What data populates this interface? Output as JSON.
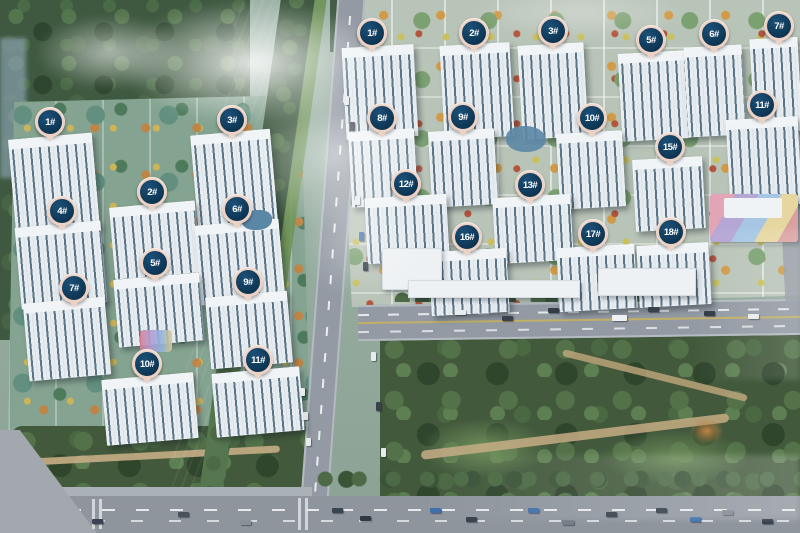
{
  "scene": {
    "type": "aerial-development-rendering",
    "description": "Bird's-eye 3D rendering of two residential communities separated by a river, with numbered building badge pins, roads with traffic, and parks"
  },
  "palette": {
    "marker_ring": "#ecd2c5",
    "marker_fill": "#0d3552",
    "marker_text": "#ffffff",
    "water": "#2b4251",
    "road": "#939aa3",
    "forest_green": "#3f5941",
    "park_green": "#42593b",
    "parcel_left_ground": "#85a391",
    "parcel_right_ground": "#b9c4b8"
  },
  "west_community": {
    "name": "west",
    "markers": [
      {
        "label": "1#",
        "x": 50,
        "y": 122
      },
      {
        "label": "2#",
        "x": 152,
        "y": 192
      },
      {
        "label": "3#",
        "x": 232,
        "y": 120
      },
      {
        "label": "4#",
        "x": 62,
        "y": 211
      },
      {
        "label": "5#",
        "x": 155,
        "y": 263
      },
      {
        "label": "6#",
        "x": 237,
        "y": 209
      },
      {
        "label": "7#",
        "x": 74,
        "y": 288
      },
      {
        "label": "9#",
        "x": 248,
        "y": 282
      },
      {
        "label": "10#",
        "x": 147,
        "y": 364
      },
      {
        "label": "11#",
        "x": 258,
        "y": 360
      }
    ]
  },
  "east_community": {
    "name": "east",
    "markers": [
      {
        "label": "1#",
        "x": 372,
        "y": 33
      },
      {
        "label": "2#",
        "x": 474,
        "y": 33
      },
      {
        "label": "3#",
        "x": 553,
        "y": 31
      },
      {
        "label": "5#",
        "x": 651,
        "y": 40
      },
      {
        "label": "6#",
        "x": 714,
        "y": 34
      },
      {
        "label": "7#",
        "x": 779,
        "y": 26
      },
      {
        "label": "8#",
        "x": 382,
        "y": 118
      },
      {
        "label": "9#",
        "x": 463,
        "y": 117
      },
      {
        "label": "10#",
        "x": 592,
        "y": 118
      },
      {
        "label": "11#",
        "x": 762,
        "y": 105
      },
      {
        "label": "12#",
        "x": 406,
        "y": 184
      },
      {
        "label": "13#",
        "x": 530,
        "y": 185
      },
      {
        "label": "15#",
        "x": 670,
        "y": 147
      },
      {
        "label": "16#",
        "x": 467,
        "y": 237
      },
      {
        "label": "17#",
        "x": 593,
        "y": 234
      },
      {
        "label": "18#",
        "x": 671,
        "y": 232
      }
    ]
  }
}
